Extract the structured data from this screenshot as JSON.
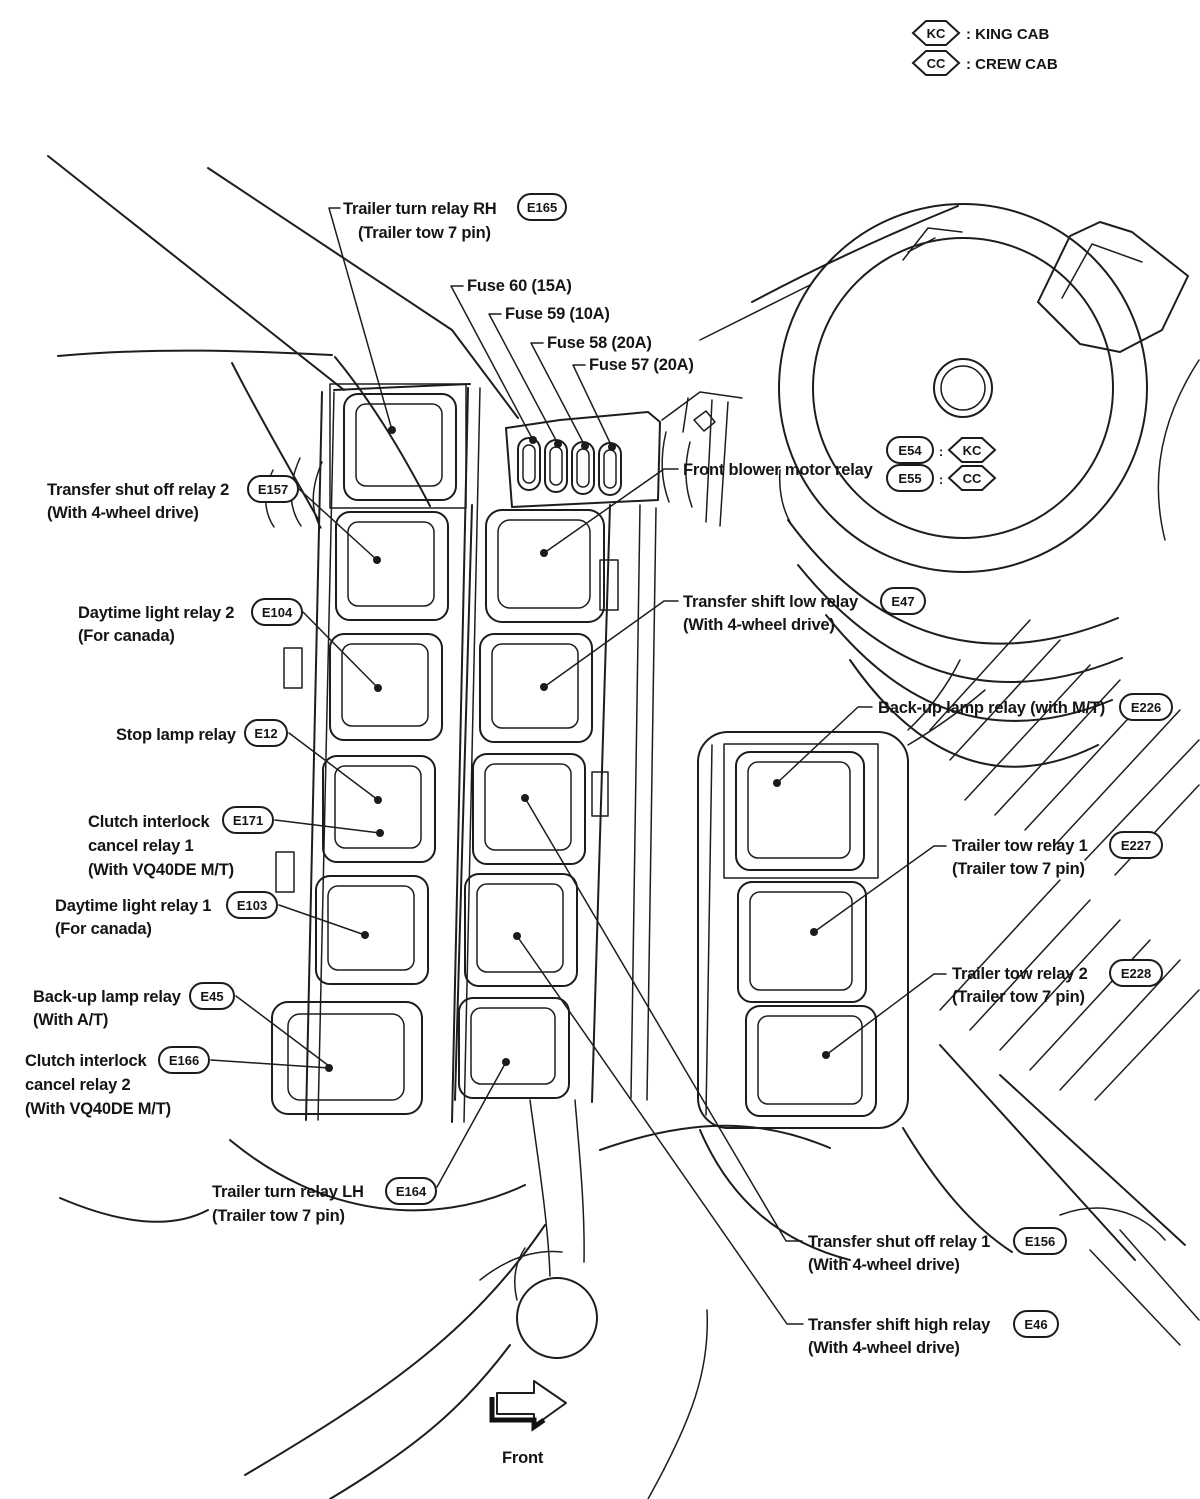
{
  "legend": {
    "items": [
      {
        "badge": "KC",
        "label": ": KING CAB"
      },
      {
        "badge": "CC",
        "label": ": CREW CAB"
      }
    ]
  },
  "variant_badges": {
    "separator": ":",
    "items": [
      {
        "code": "E54",
        "variant": "KC"
      },
      {
        "code": "E55",
        "variant": "CC"
      }
    ]
  },
  "fuse_labels": [
    "Fuse 60 (15A)",
    "Fuse 59 (10A)",
    "Fuse 58 (20A)",
    "Fuse 57 (20A)"
  ],
  "callouts": [
    {
      "line1": "Trailer turn relay RH",
      "badge": "E165",
      "line2": "(Trailer tow 7 pin)"
    },
    {
      "line1": "Transfer shut off relay 2",
      "badge": "E157",
      "line2": "(With 4-wheel drive)"
    },
    {
      "line1": "Daytime light relay 2",
      "badge": "E104",
      "line2": "(For canada)"
    },
    {
      "line1": "Stop lamp relay",
      "badge": "E12",
      "line2": ""
    },
    {
      "line1": "Clutch interlock",
      "badge": "E171",
      "line2": "cancel relay 1",
      "line3": "(With VQ40DE M/T)"
    },
    {
      "line1": "Daytime light relay 1",
      "badge": "E103",
      "line2": "(For canada)"
    },
    {
      "line1": "Back-up lamp relay",
      "badge": "E45",
      "line2": "(With A/T)"
    },
    {
      "line1": "Clutch interlock",
      "badge": "E166",
      "line2": "cancel relay 2",
      "line3": "(With VQ40DE M/T)"
    },
    {
      "line1": "Front blower motor relay",
      "badge": "",
      "line2": ""
    },
    {
      "line1": "Transfer shift low relay",
      "badge": "E47",
      "line2": "(With 4-wheel drive)"
    },
    {
      "line1": "Back-up lamp relay (with M/T)",
      "badge": "E226",
      "line2": ""
    },
    {
      "line1": "Trailer tow relay 1",
      "badge": "E227",
      "line2": "(Trailer tow 7 pin)"
    },
    {
      "line1": "Trailer tow relay 2",
      "badge": "E228",
      "line2": "(Trailer tow 7 pin)"
    },
    {
      "line1": "Trailer turn relay LH",
      "badge": "E164",
      "line2": "(Trailer tow 7 pin)"
    },
    {
      "line1": "Transfer shut off relay 1",
      "badge": "E156",
      "line2": "(With 4-wheel drive)"
    },
    {
      "line1": "Transfer shift high relay",
      "badge": "E46",
      "line2": "(With 4-wheel drive)"
    }
  ],
  "front_arrow_label": "Front"
}
